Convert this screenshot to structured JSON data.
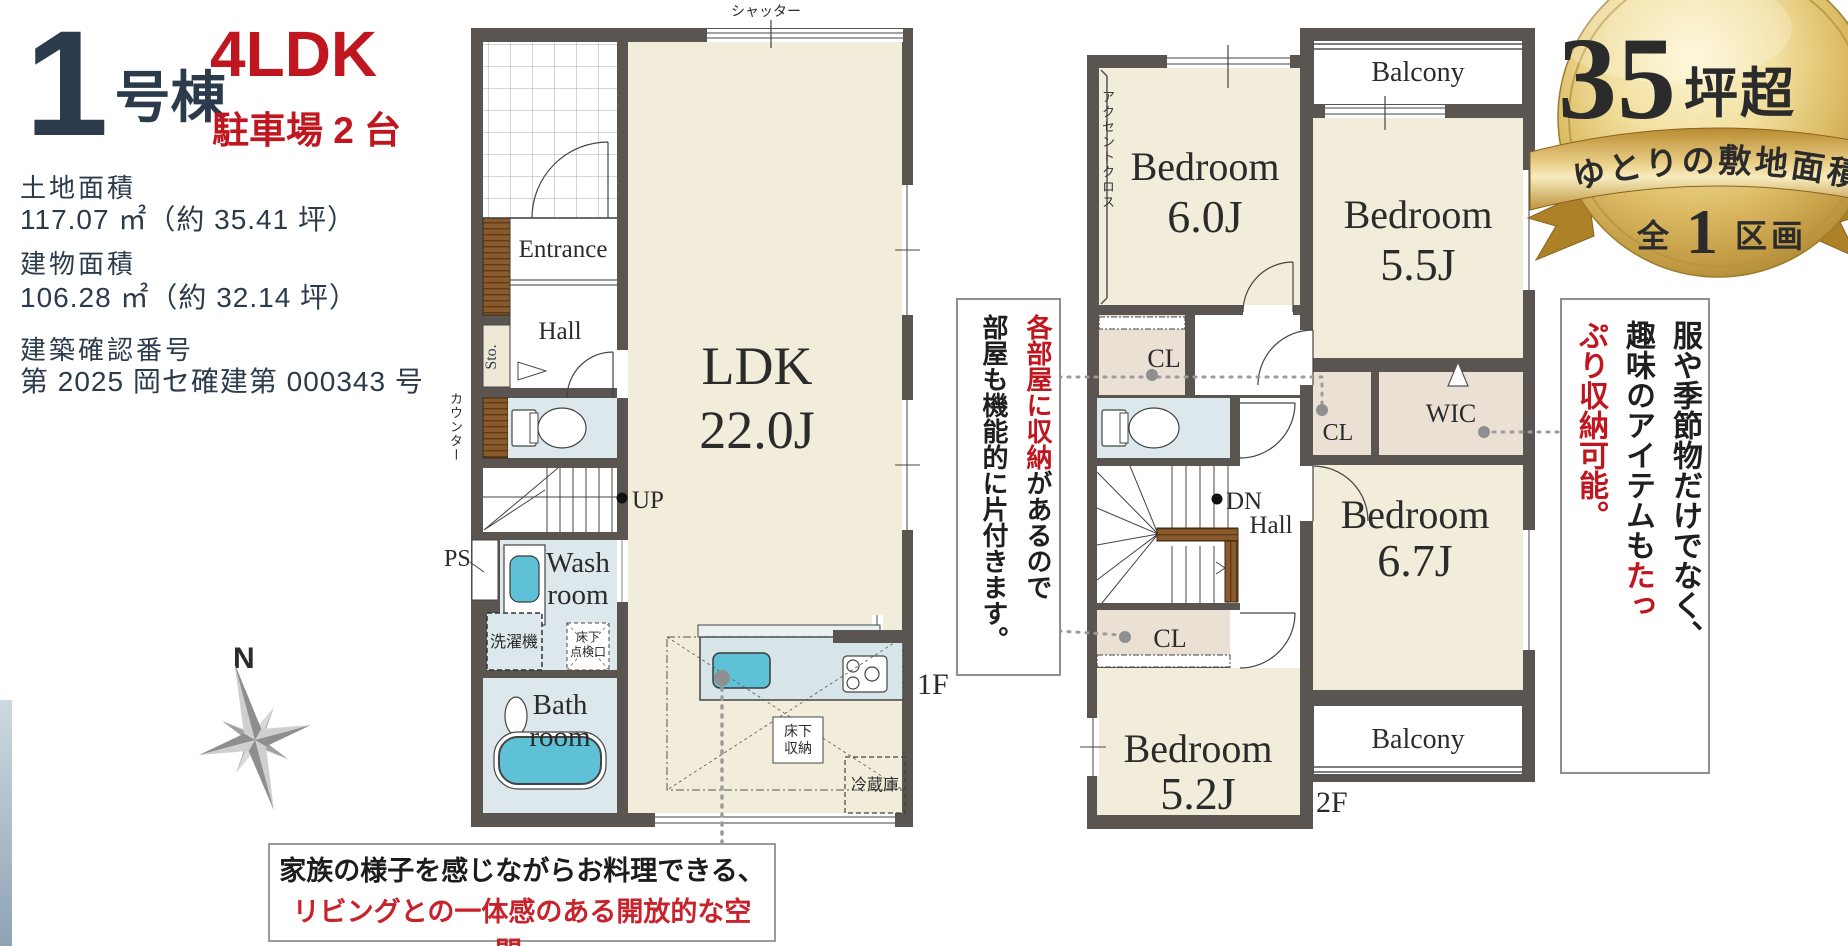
{
  "colors": {
    "accent_red": "#c0161f",
    "navy": "#2c3b4b",
    "wall_gray": "#5a5551",
    "room_cream": "#f2ecda",
    "wet_blue": "#dce8ec",
    "closet_beige": "#ebe0d4",
    "fixture_teal": "#5ec1d6",
    "badge_red": "#a31d26",
    "badge_gold": "#d9b95c"
  },
  "header": {
    "number": "1",
    "suffix": "号棟",
    "layout": "4LDK",
    "parking": "駐車場 2 台"
  },
  "specs": {
    "land_label": "土地面積",
    "land_value": "117.07 ㎡（約 35.41 坪）",
    "bldg_label": "建物面積",
    "bldg_value": "106.28 ㎡（約 32.14 坪）",
    "permit_label": "建築確認番号",
    "permit_value": "第 2025 岡セ確建第 000343 号"
  },
  "compass": {
    "north": "N"
  },
  "floor1": {
    "label": "1F",
    "shutter": "シャッター",
    "entrance": "Entrance",
    "hall": "Hall",
    "sto": "Sto.",
    "counter": "カウンター",
    "up": "UP",
    "ps": "PS",
    "wash1": "Wash",
    "wash2": "room",
    "washer": "洗濯機",
    "hatch1": "床下",
    "hatch2": "点検口",
    "bath1": "Bath",
    "bath2": "room",
    "ldk1": "LDK",
    "ldk2": "22.0J",
    "ustorage1": "床下",
    "ustorage2": "収納",
    "fridge": "冷蔵庫"
  },
  "floor2": {
    "label": "2F",
    "accent": "アクセントクロス",
    "bed1_1": "Bedroom",
    "bed1_2": "6.0J",
    "bed2_1": "Bedroom",
    "bed2_2": "5.5J",
    "bed3_1": "Bedroom",
    "bed3_2": "6.7J",
    "bed4_1": "Bedroom",
    "bed4_2": "5.2J",
    "balcony": "Balcony",
    "cl": "CL",
    "wic": "WIC",
    "dn": "DN",
    "hall": "Hall"
  },
  "badge": {
    "number": "35",
    "unit": "坪超",
    "ribbon": "ゆとりの敷地面積",
    "total_pre": "全",
    "total_num": "1",
    "total_suf": "区画"
  },
  "notes": {
    "storage_c1_red": "各部屋に収納",
    "storage_c1": "があるので",
    "storage_c2": "部屋も機能的に片付きます。",
    "wic_c1": "服や季節物だけでなく、",
    "wic_c2": "趣味のアイテムも",
    "wic_c2_red": "たっ",
    "wic_c3_red": "ぷり収納可能。",
    "kitchen_l1": "家族の様子を感じながらお料理できる、",
    "kitchen_l2": "リビングとの一体感のある開放的な空間。"
  }
}
